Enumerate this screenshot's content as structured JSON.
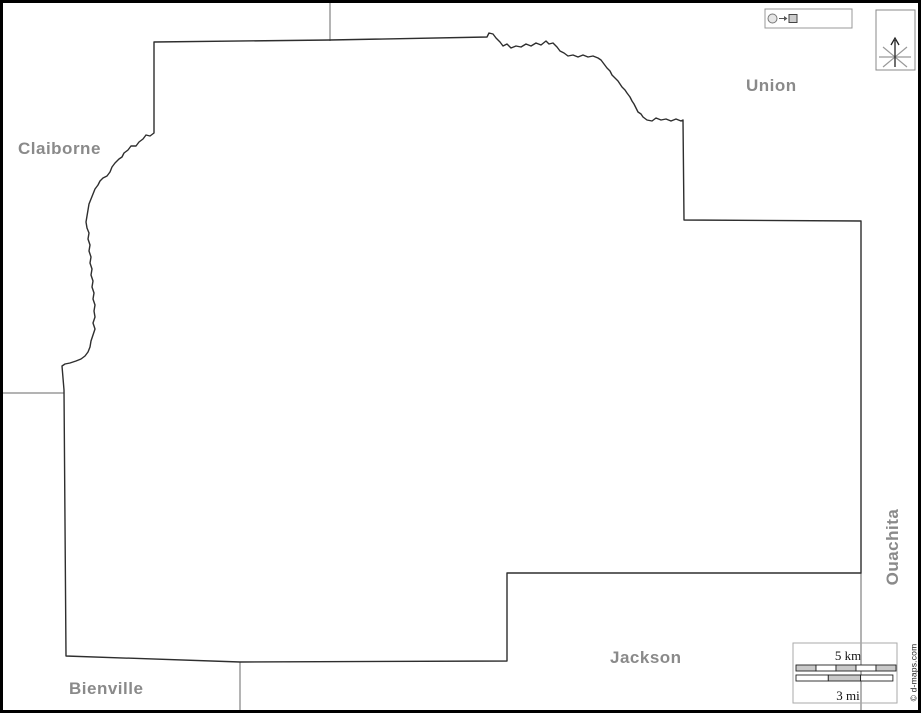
{
  "projection_badge": {
    "icon": "circle-arrow-square-icon",
    "label": "Mercator"
  },
  "compass": {
    "label": "N"
  },
  "labels": {
    "claiborne": "Claiborne",
    "union": "Union",
    "ouachita": "Ouachita",
    "jackson": "Jackson",
    "bienville": "Bienville"
  },
  "scale_bar": {
    "km_label": "5 km",
    "mi_label": "3 mi",
    "km_segments": 5,
    "mi_segments": 3
  },
  "credit": "© d-maps.com",
  "colors": {
    "label_gray": "#8a8a8a",
    "parish_outline": "#2e2e2e",
    "boundary_line": "#9a9a9a",
    "bar_fill_gray": "#c9c9c9",
    "frame_border": "#000000"
  }
}
